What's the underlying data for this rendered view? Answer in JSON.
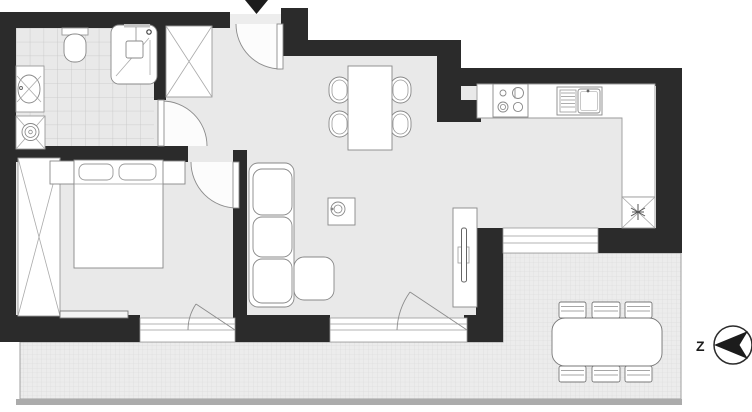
{
  "compass": {
    "label": "Z"
  },
  "entrance": {
    "marker": "down-arrow"
  },
  "colors": {
    "wall": "#2b2b2b",
    "floor": "#e9e9e9",
    "fixture_fill": "#ffffff",
    "outline": "#888888",
    "tile_line": "#c6c6c6",
    "terrace_fill": "#ececec",
    "terrace_line": "#d7d7d7",
    "marker": "#1c1c1c"
  },
  "rooms": {
    "bathroom": {
      "fixtures": [
        "toilet",
        "shower",
        "washbasin",
        "washing-machine"
      ]
    },
    "hallway": {
      "fixtures": [
        "wardrobe",
        "entrance-door"
      ]
    },
    "bedroom": {
      "fixtures": [
        "wardrobe",
        "double-bed",
        "nightstand-left",
        "nightstand-right",
        "radiator"
      ]
    },
    "living_room": {
      "fixtures": [
        "corner-sofa",
        "coffee-table",
        "dining-table",
        "tv-sideboard"
      ],
      "dining_chairs": 4
    },
    "kitchen": {
      "fixtures": [
        "cooktop",
        "kitchen-sink",
        "l-counter",
        "refrigerator"
      ]
    },
    "terrace": {
      "fixtures": [
        "outdoor-table"
      ],
      "outdoor_chairs": 6
    }
  }
}
